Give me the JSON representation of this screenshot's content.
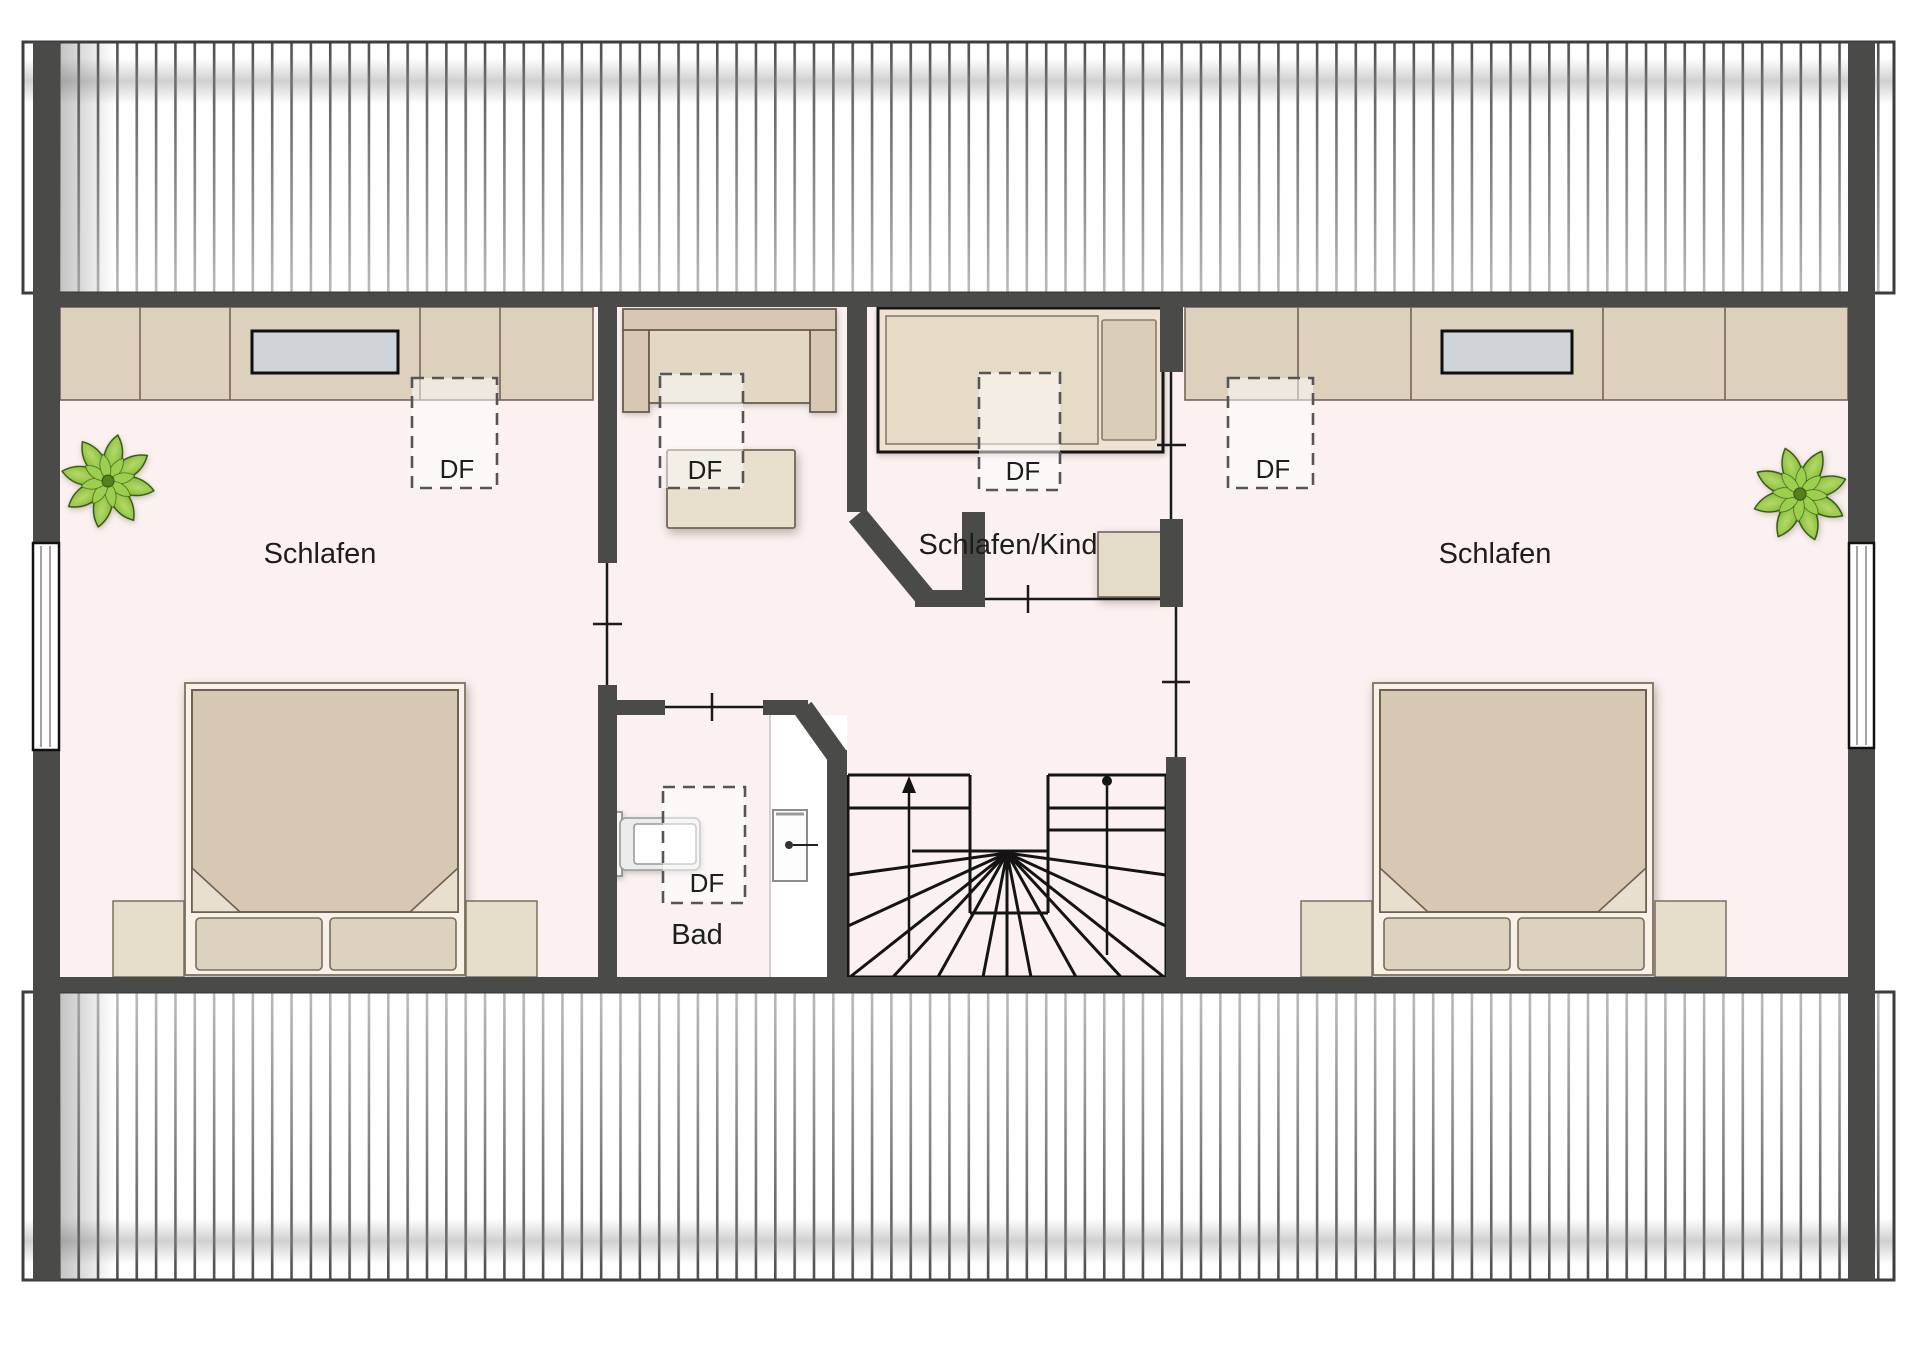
{
  "floor_plan": {
    "rooms": {
      "bedroom_left": {
        "label": "Schlafen"
      },
      "child_bedroom": {
        "label": "Schlafen/Kind"
      },
      "bathroom": {
        "label": "Bad"
      },
      "bedroom_right": {
        "label": "Schlafen"
      }
    },
    "roof_window_label": "DF",
    "colors": {
      "wall": "#4a4a48",
      "floor": "#fbf1f0",
      "furniture_beige": "#ddd1bd",
      "furniture_light": "#e7dcca",
      "bed_blanket": "#d6c8b2",
      "outline_brown": "#6e6257",
      "mirror_gray": "#cfd4d8",
      "plant_green": "#76b82a",
      "stair_line": "#141414"
    }
  }
}
